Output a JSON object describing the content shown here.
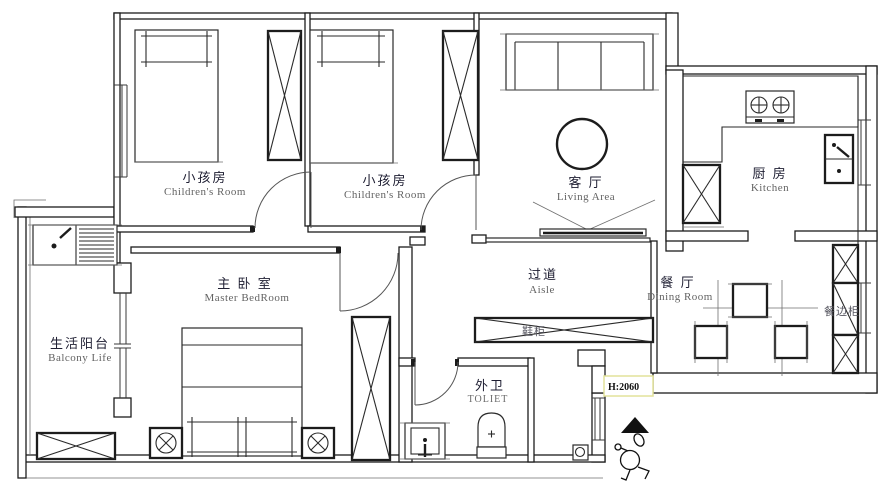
{
  "title": "Apartment Floor Plan",
  "colors": {
    "wall_line": "#1c1c1c",
    "label_zh": "#1e1e32",
    "label_en": "#636363",
    "annotation_border": "#e2e29a",
    "annotation_text": "#111111"
  },
  "rooms": [
    {
      "id": "children-room-1",
      "zh": "小孩房",
      "en": "Children's Room"
    },
    {
      "id": "children-room-2",
      "zh": "小孩房",
      "en": "Children's Room"
    },
    {
      "id": "living-area",
      "zh": "客 厅",
      "en": "Living Area"
    },
    {
      "id": "kitchen",
      "zh": "厨 房",
      "en": "Kitchen"
    },
    {
      "id": "master-bedroom",
      "zh": "主 卧 室",
      "en": "Master BedRoom"
    },
    {
      "id": "aisle",
      "zh": "过道",
      "en": "Aisle"
    },
    {
      "id": "dining-room",
      "zh": "餐 厅",
      "en": "Dining Room"
    },
    {
      "id": "balcony",
      "zh": "生活阳台",
      "en": "Balcony Life"
    },
    {
      "id": "toilet",
      "zh": "外卫",
      "en": "TOLIET"
    }
  ],
  "furniture_labels": {
    "shoe_cabinet": "鞋柜",
    "sideboard": "餐边柜"
  },
  "annotations": {
    "door_height": "H:2060"
  }
}
